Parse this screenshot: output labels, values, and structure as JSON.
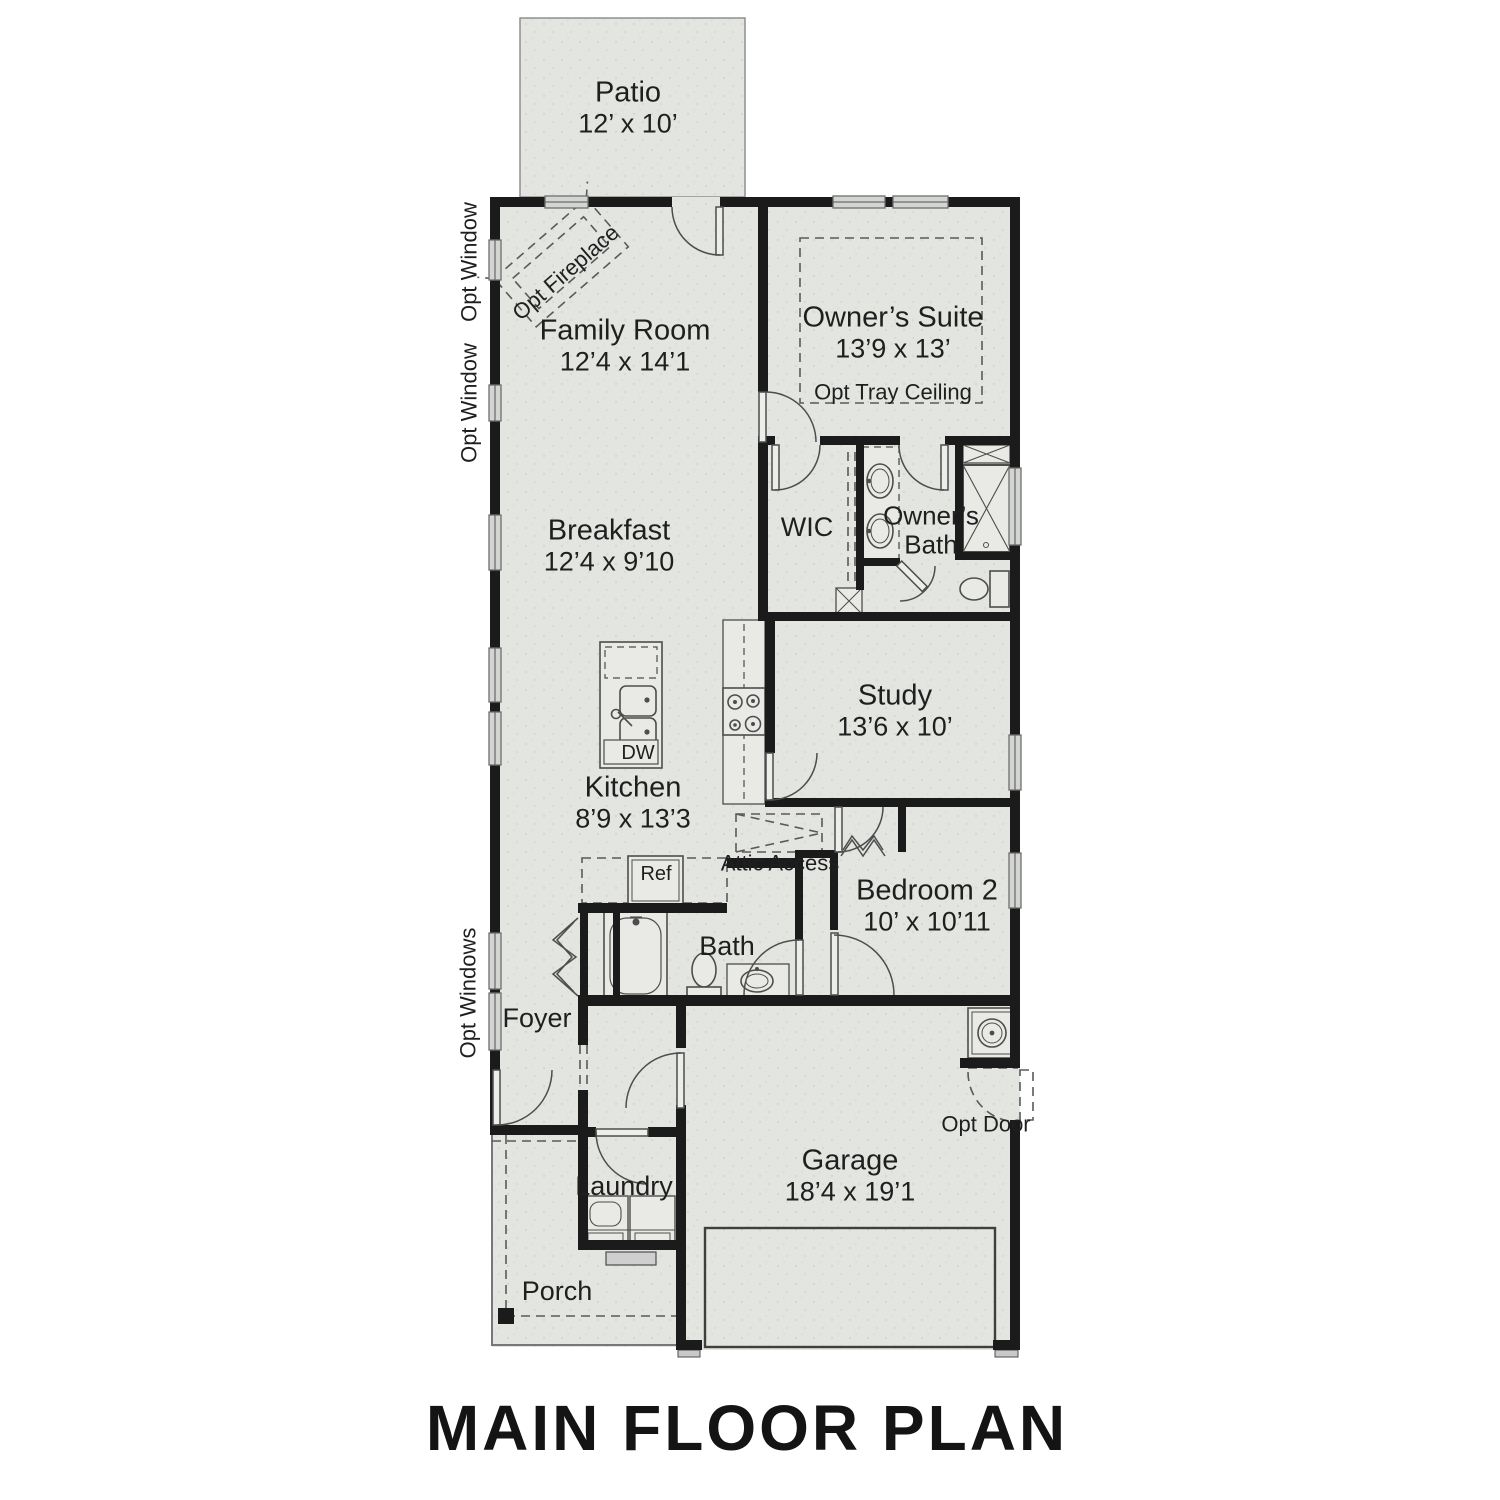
{
  "title": "MAIN FLOOR PLAN",
  "rooms": {
    "patio": {
      "label": "Patio",
      "dims": "12’ x 10’"
    },
    "family_room": {
      "label": "Family Room",
      "dims": "12’4 x 14’1"
    },
    "owners_suite": {
      "label": "Owner’s Suite",
      "dims": "13’9 x 13’"
    },
    "wic": {
      "label": "WIC"
    },
    "owners_bath": {
      "label": "Owner’s Bath"
    },
    "breakfast": {
      "label": "Breakfast",
      "dims": "12’4 x 9’10"
    },
    "study": {
      "label": "Study",
      "dims": "13’6 x 10’"
    },
    "kitchen": {
      "label": "Kitchen",
      "dims": "8’9 x 13’3"
    },
    "bedroom2": {
      "label": "Bedroom 2",
      "dims": "10’ x 10’11"
    },
    "bath": {
      "label": "Bath"
    },
    "foyer": {
      "label": "Foyer"
    },
    "laundry": {
      "label": "Laundry"
    },
    "garage": {
      "label": "Garage",
      "dims": "18’4 x 19’1"
    },
    "porch": {
      "label": "Porch"
    }
  },
  "annotations": {
    "opt_window_1": "Opt Window",
    "opt_window_2": "Opt Window",
    "opt_windows": "Opt Windows",
    "opt_fireplace": "Opt Fireplace",
    "opt_tray_ceiling": "Opt Tray Ceiling",
    "attic_access": "Attic Access",
    "opt_door": "Opt Door",
    "ref": "Ref",
    "dw": "DW"
  },
  "colors": {
    "floor": "#e3e5e1",
    "speckle": "#d6d8d3",
    "wall": "#1b1b1b",
    "line": "#4d4d4d",
    "window": "#d3d5d2",
    "text": "#1f1f1f"
  }
}
